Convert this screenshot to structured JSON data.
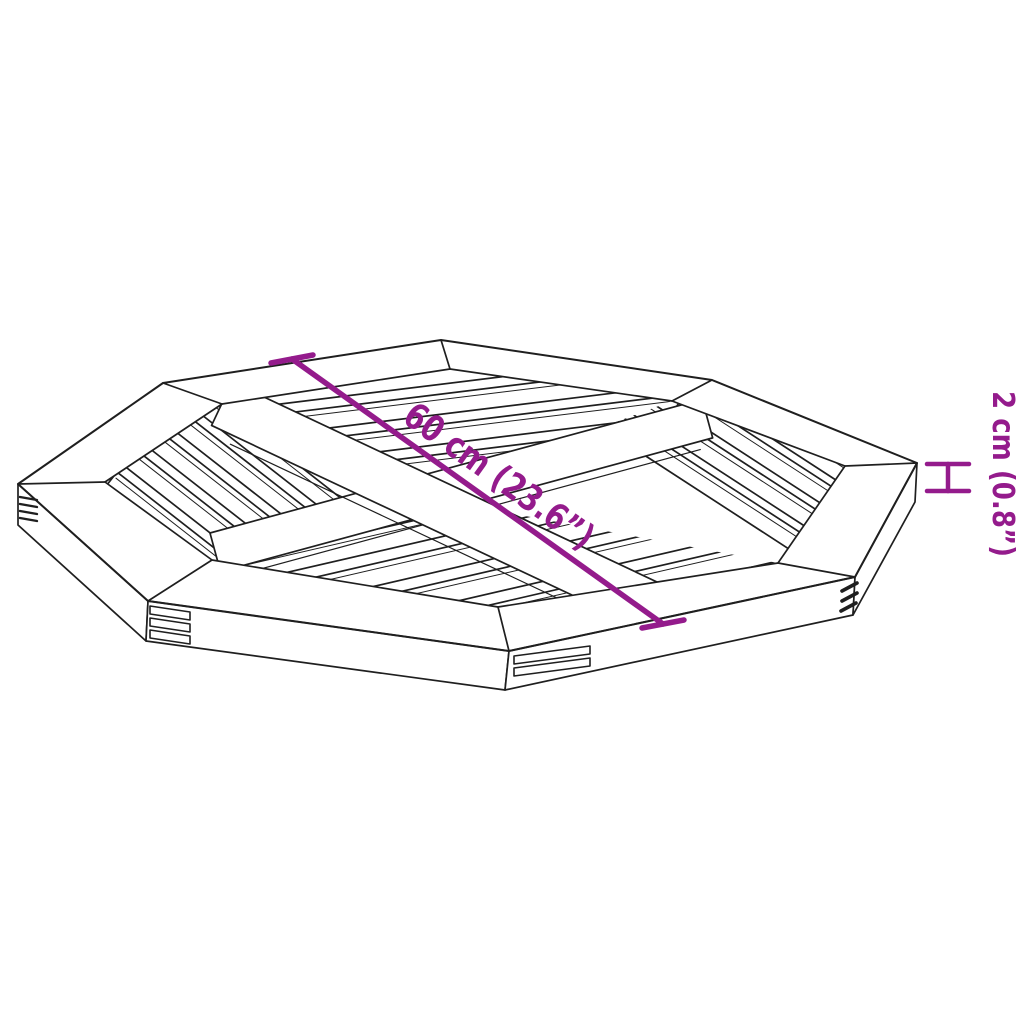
{
  "annotations": {
    "diagonal_label": "60 cm (23.6”)",
    "thickness_label": "2 cm (0.8”)"
  },
  "colors": {
    "accent": "#941b8c",
    "line": "#1f1f1f",
    "background": "#ffffff"
  },
  "icons": {
    "thickness_marker": "i-beam-dimension-icon"
  }
}
